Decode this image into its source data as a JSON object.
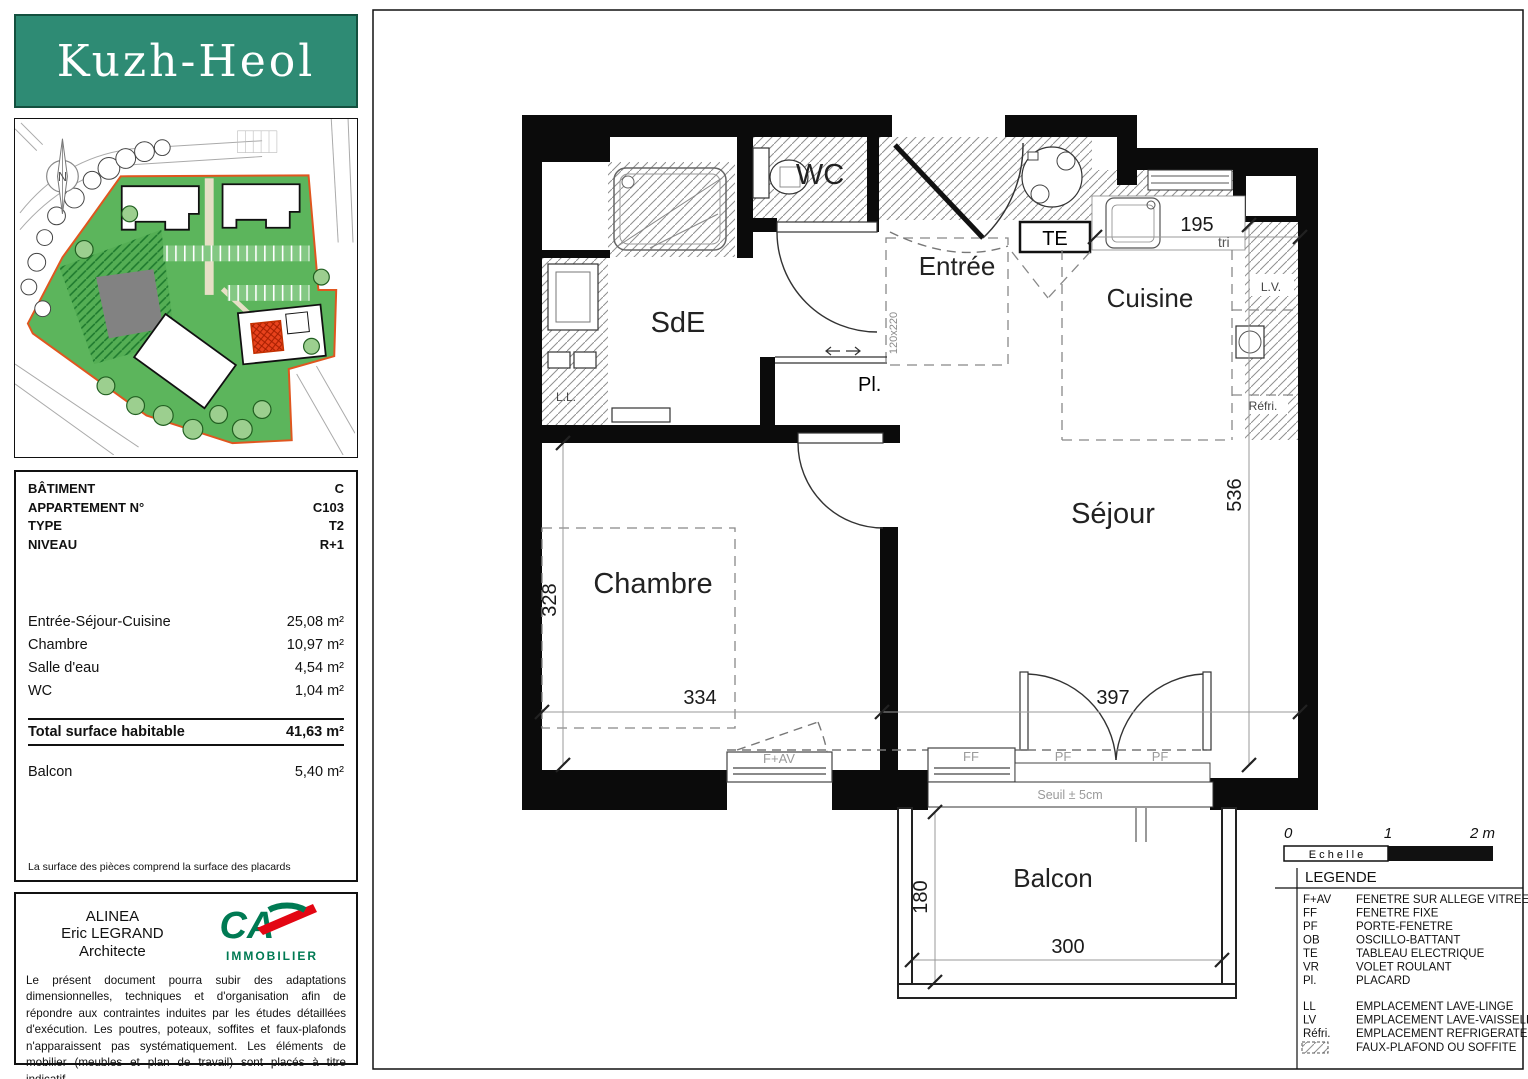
{
  "logo": {
    "text": "Kuzh-Heol"
  },
  "siteplan": {
    "compass": "N"
  },
  "info": {
    "rows": [
      {
        "label": "BÂTIMENT",
        "value": "C"
      },
      {
        "label": "APPARTEMENT N°",
        "value": "C103"
      },
      {
        "label": "TYPE",
        "value": "T2"
      },
      {
        "label": "NIVEAU",
        "value": "R+1"
      }
    ]
  },
  "areas": {
    "rows": [
      {
        "label": "Entrée-Séjour-Cuisine",
        "value": "25,08 m²"
      },
      {
        "label": "Chambre",
        "value": "10,97 m²"
      },
      {
        "label": "Salle d'eau",
        "value": "4,54 m²"
      },
      {
        "label": "WC",
        "value": "1,04 m²"
      }
    ],
    "total": {
      "label": "Total surface habitable",
      "value": "41,63 m²"
    },
    "balcony": {
      "label": "Balcon",
      "value": "5,40 m²"
    },
    "note": "La surface des pièces comprend la surface des placards"
  },
  "architect": {
    "line1": "ALINEA",
    "line2": "Eric LEGRAND",
    "line3": "Architecte",
    "logo_brand": "CA",
    "logo_sub": "IMMOBILIER",
    "disclaimer": "Le présent document pourra subir des adaptations dimensionnelles, techniques et d'organisation afin de répondre aux contraintes induites par les études détaillées d'exécution. Les poutres, poteaux, soffites et faux-plafonds n'apparaissent pas systématiquement. Les éléments de mobilier (meubles et plan de travail) sont placés à titre indicatif.",
    "date": "Date : 1er Février 2025"
  },
  "plan": {
    "rooms": {
      "sde": "SdE",
      "wc": "WC",
      "entree": "Entrée",
      "cuisine": "Cuisine",
      "sejour": "Séjour",
      "chambre": "Chambre",
      "balcon": "Balcon"
    },
    "annotations": {
      "te": "TE",
      "pl": "Pl.",
      "ll": "L.L.",
      "lv": "L.V.",
      "refri": "Réfri.",
      "tri": "tri",
      "seuil": "Seuil ± 5cm",
      "door_size": "120x220"
    },
    "dims": {
      "chambre_w": "334",
      "sejour_w": "397",
      "chambre_h": "328",
      "sejour_h": "536",
      "cuisine_w": "195",
      "balcon_w": "300",
      "balcon_d": "180"
    },
    "openings": {
      "fav": "F+AV",
      "ff": "FF",
      "pf1": "PF",
      "pf2": "PF"
    }
  },
  "scale": {
    "t0": "0",
    "t1": "1",
    "t2": "2 m",
    "label": "E c h e l l e"
  },
  "legend": {
    "title": "LEGENDE",
    "entries": [
      {
        "abbr": "F+AV",
        "desc": "FENETRE SUR ALLEGE VITREE"
      },
      {
        "abbr": "FF",
        "desc": "FENETRE FIXE"
      },
      {
        "abbr": "PF",
        "desc": "PORTE-FENETRE"
      },
      {
        "abbr": "OB",
        "desc": "OSCILLO-BATTANT"
      },
      {
        "abbr": "TE",
        "desc": "TABLEAU ELECTRIQUE"
      },
      {
        "abbr": "VR",
        "desc": "VOLET ROULANT"
      },
      {
        "abbr": "Pl.",
        "desc": "PLACARD"
      },
      {
        "abbr": "LL",
        "desc": "EMPLACEMENT LAVE-LINGE"
      },
      {
        "abbr": "LV",
        "desc": "EMPLACEMENT LAVE-VAISSELLE"
      },
      {
        "abbr": "Réfri.",
        "desc": "EMPLACEMENT REFRIGERATEUR"
      },
      {
        "abbr": "",
        "desc": "FAUX-PLAFOND OU SOFFITE"
      }
    ]
  },
  "colors": {
    "teal": "#2E8B74",
    "site_green": "#5CB55C",
    "boundary_orange": "#E0561F",
    "highlight_red": "#E8421C",
    "ca_green": "#007A53",
    "ca_red": "#E30613"
  }
}
